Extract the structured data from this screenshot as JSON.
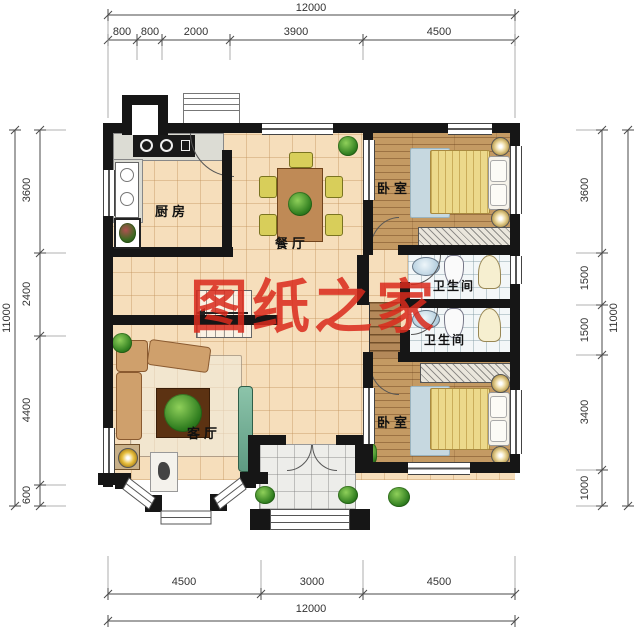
{
  "title": "residential floor plan",
  "watermark": {
    "text": "图纸之家",
    "color": "#da2a1c"
  },
  "rooms": {
    "kitchen": {
      "label": "厨房"
    },
    "dining": {
      "label": "餐厅"
    },
    "bedroom_top": {
      "label": "卧室"
    },
    "bathroom_upper": {
      "label": "卫生间"
    },
    "bathroom_lower": {
      "label": "卫生间"
    },
    "bedroom_bottom": {
      "label": "卧室"
    },
    "living": {
      "label": "客厅"
    }
  },
  "dimensions": {
    "top": {
      "total": "12000",
      "segments": [
        "800",
        "800",
        "2000",
        "3900",
        "4500"
      ]
    },
    "bottom": {
      "total": "12000",
      "segments": [
        "4500",
        "3000",
        "4500"
      ]
    },
    "left": {
      "total": "11000",
      "segments": [
        "3600",
        "2400",
        "4400",
        "600"
      ]
    },
    "right": {
      "total": "11000",
      "segments": [
        "3600",
        "1500",
        "1500",
        "3400",
        "1000"
      ]
    }
  },
  "colors": {
    "wall": "#161616",
    "tile_floor": "#f6debb",
    "wood_floor": "#c49a63",
    "watermark_red": "#da2a1c"
  }
}
